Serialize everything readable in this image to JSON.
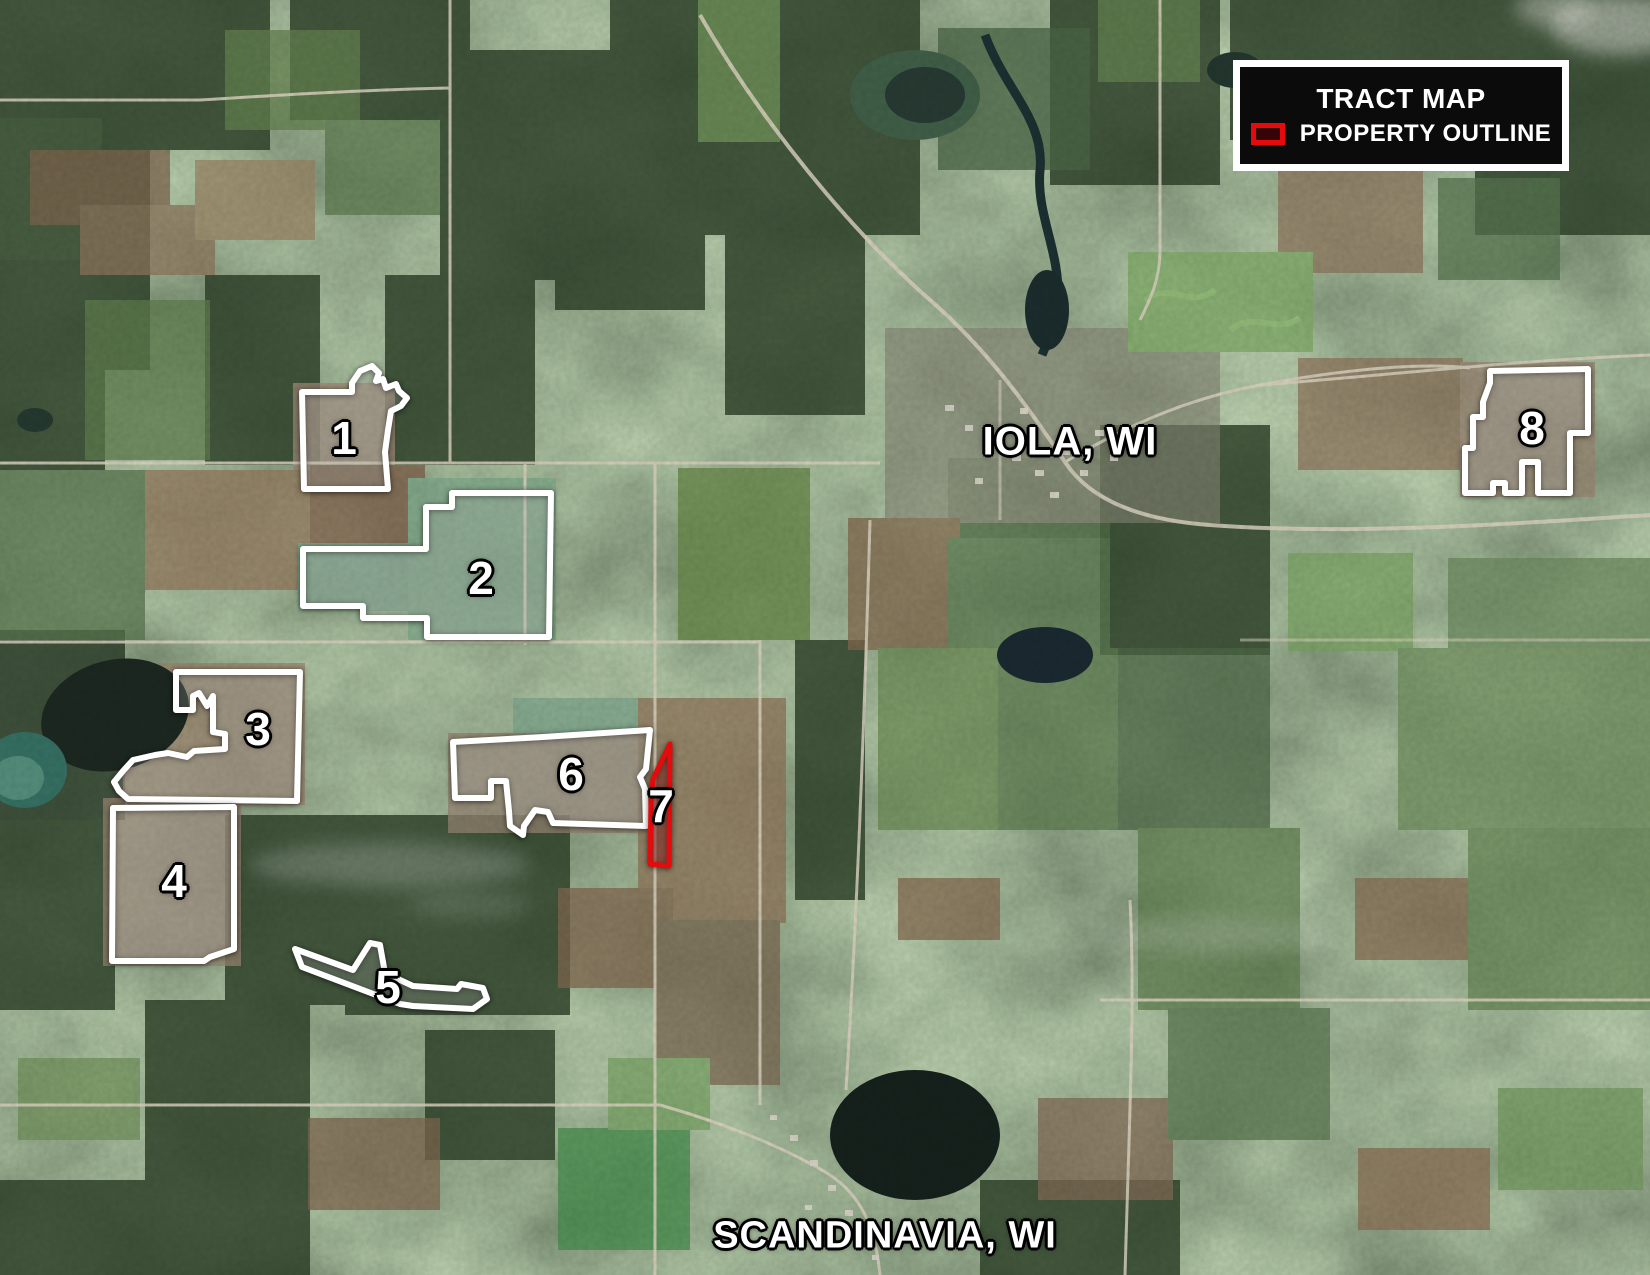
{
  "map": {
    "legend": {
      "title": "TRACT MAP",
      "swatch_label": "PROPERTY OUTLINE",
      "outline_color": "#e30b0b"
    },
    "colors": {
      "tract_outline_white": "#ffffff",
      "property_outline_red": "#e30b0b"
    },
    "cities": [
      {
        "name": "IOLA, WI",
        "x": 1070,
        "y": 442,
        "size": "large"
      },
      {
        "name": "SCANDINAVIA, WI",
        "x": 885,
        "y": 1236,
        "size": "small"
      }
    ],
    "tracts": [
      {
        "number": "1",
        "style": "white",
        "label_x": 344,
        "label_y": 438,
        "points": [
          [
            302,
            392
          ],
          [
            352,
            392
          ],
          [
            352,
            383
          ],
          [
            360,
            371
          ],
          [
            372,
            366
          ],
          [
            379,
            373
          ],
          [
            376,
            381
          ],
          [
            383,
            379
          ],
          [
            386,
            388
          ],
          [
            396,
            384
          ],
          [
            399,
            391
          ],
          [
            407,
            398
          ],
          [
            401,
            406
          ],
          [
            391,
            411
          ],
          [
            388,
            430
          ],
          [
            385,
            452
          ],
          [
            388,
            489
          ],
          [
            304,
            489
          ]
        ]
      },
      {
        "number": "2",
        "style": "white",
        "label_x": 481,
        "label_y": 578,
        "points": [
          [
            452,
            493
          ],
          [
            551,
            493
          ],
          [
            549,
            637
          ],
          [
            427,
            637
          ],
          [
            427,
            618
          ],
          [
            363,
            618
          ],
          [
            363,
            606
          ],
          [
            303,
            606
          ],
          [
            303,
            549
          ],
          [
            426,
            549
          ],
          [
            426,
            507
          ],
          [
            452,
            507
          ]
        ]
      },
      {
        "number": "3",
        "style": "white",
        "label_x": 258,
        "label_y": 729,
        "points": [
          [
            176,
            672
          ],
          [
            300,
            672
          ],
          [
            297,
            801
          ],
          [
            128,
            799
          ],
          [
            119,
            791
          ],
          [
            114,
            782
          ],
          [
            123,
            771
          ],
          [
            133,
            760
          ],
          [
            155,
            755
          ],
          [
            168,
            753
          ],
          [
            187,
            757
          ],
          [
            194,
            751
          ],
          [
            225,
            749
          ],
          [
            225,
            734
          ],
          [
            213,
            732
          ],
          [
            213,
            696
          ],
          [
            207,
            706
          ],
          [
            199,
            693
          ],
          [
            193,
            696
          ],
          [
            193,
            710
          ],
          [
            176,
            710
          ]
        ]
      },
      {
        "number": "4",
        "style": "white",
        "label_x": 174,
        "label_y": 881,
        "points": [
          [
            113,
            808
          ],
          [
            234,
            807
          ],
          [
            234,
            949
          ],
          [
            210,
            957
          ],
          [
            204,
            961
          ],
          [
            112,
            961
          ]
        ]
      },
      {
        "number": "5",
        "style": "white",
        "label_x": 388,
        "label_y": 987,
        "points": [
          [
            295,
            949
          ],
          [
            353,
            970
          ],
          [
            370,
            943
          ],
          [
            380,
            945
          ],
          [
            385,
            973
          ],
          [
            413,
            986
          ],
          [
            457,
            989
          ],
          [
            461,
            984
          ],
          [
            483,
            988
          ],
          [
            487,
            999
          ],
          [
            473,
            1009
          ],
          [
            413,
            1006
          ],
          [
            400,
            1004
          ],
          [
            302,
            967
          ]
        ]
      },
      {
        "number": "6",
        "style": "white",
        "label_x": 571,
        "label_y": 774,
        "points": [
          [
            453,
            742
          ],
          [
            543,
            737
          ],
          [
            650,
            730
          ],
          [
            646,
            769
          ],
          [
            640,
            777
          ],
          [
            645,
            789
          ],
          [
            646,
            826
          ],
          [
            553,
            823
          ],
          [
            548,
            812
          ],
          [
            535,
            810
          ],
          [
            524,
            826
          ],
          [
            523,
            835
          ],
          [
            510,
            826
          ],
          [
            509,
            811
          ],
          [
            506,
            781
          ],
          [
            491,
            781
          ],
          [
            491,
            798
          ],
          [
            455,
            798
          ]
        ]
      },
      {
        "number": "7",
        "style": "red",
        "label_x": 661,
        "label_y": 806,
        "points": [
          [
            670,
            744
          ],
          [
            669,
            866
          ],
          [
            650,
            864
          ],
          [
            651,
            800
          ],
          [
            653,
            779
          ]
        ]
      },
      {
        "number": "8",
        "style": "white",
        "label_x": 1532,
        "label_y": 428,
        "points": [
          [
            1490,
            371
          ],
          [
            1588,
            369
          ],
          [
            1588,
            433
          ],
          [
            1570,
            433
          ],
          [
            1570,
            493
          ],
          [
            1538,
            493
          ],
          [
            1538,
            462
          ],
          [
            1522,
            462
          ],
          [
            1522,
            493
          ],
          [
            1505,
            493
          ],
          [
            1505,
            483
          ],
          [
            1493,
            483
          ],
          [
            1493,
            493
          ],
          [
            1465,
            493
          ],
          [
            1465,
            448
          ],
          [
            1473,
            448
          ],
          [
            1473,
            417
          ],
          [
            1483,
            417
          ],
          [
            1483,
            402
          ],
          [
            1490,
            383
          ]
        ]
      }
    ]
  }
}
